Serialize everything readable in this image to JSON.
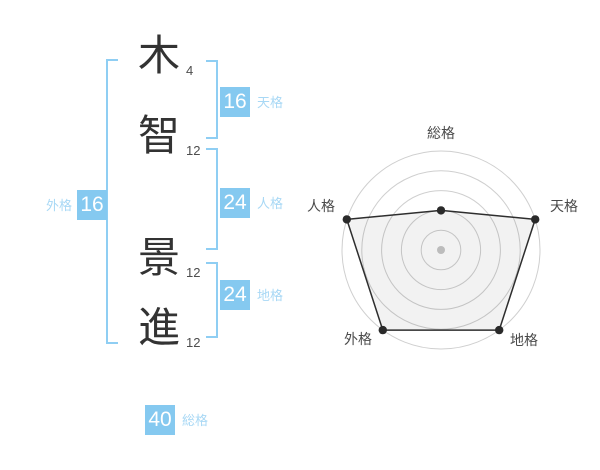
{
  "name_panel": {
    "characters": [
      {
        "char": "木",
        "strokes": "4"
      },
      {
        "char": "智",
        "strokes": "12"
      },
      {
        "char": "景",
        "strokes": "12"
      },
      {
        "char": "進",
        "strokes": "12"
      }
    ],
    "badges": {
      "tenkaku": {
        "value": "16",
        "label": "天格"
      },
      "jinkaku": {
        "value": "24",
        "label": "人格"
      },
      "chikaku": {
        "value": "24",
        "label": "地格"
      },
      "gaikaku": {
        "value": "16",
        "label": "外格"
      },
      "soukaku": {
        "value": "40",
        "label": "総格"
      }
    }
  },
  "colors": {
    "badge_bg": "#85c9f0",
    "badge_value_text": "#ffffff",
    "badge_label_text": "#a8d8f5",
    "bracket": "#8fcef3",
    "kanji_text": "#333333",
    "stroke_count_text": "#4d4d4d",
    "radar_ring": "#cfcfcf",
    "radar_polygon_stroke": "#2e2e2e",
    "radar_polygon_fill": "rgba(0,0,0,0.05)",
    "radar_point": "#2a2a2a",
    "radar_center_dot": "#bcbcbc",
    "radar_label": "#4a4a4a"
  },
  "chart_data": {
    "type": "radar",
    "axes": [
      "総格",
      "天格",
      "地格",
      "外格",
      "人格"
    ],
    "axis_stroke_totals": {
      "総格": 40,
      "天格": 16,
      "地格": 24,
      "外格": 16,
      "人格": 24
    },
    "series": [
      {
        "name": "name-fortune-rating",
        "values": [
          2,
          5,
          5,
          5,
          5
        ]
      }
    ],
    "scale": {
      "min": 0,
      "max": 5,
      "rings": 5
    },
    "grid": "circular",
    "legend": "none"
  }
}
